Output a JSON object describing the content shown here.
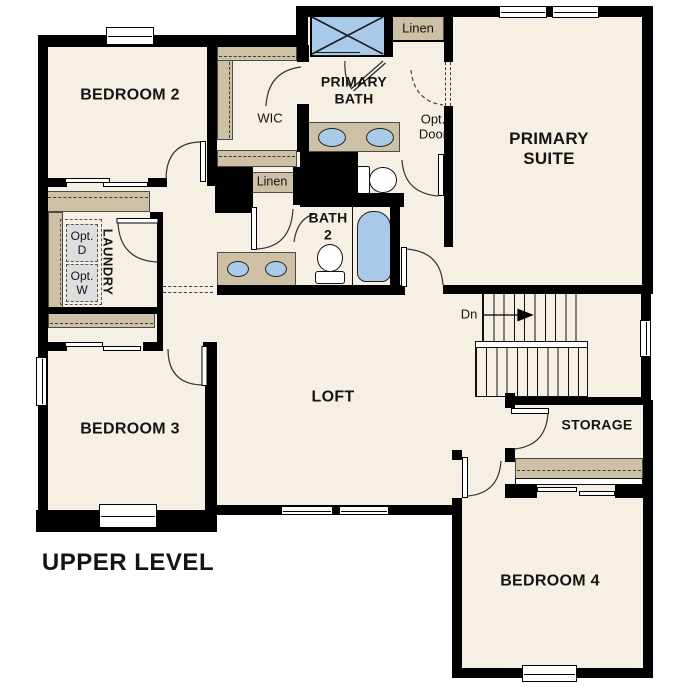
{
  "title": "UPPER LEVEL",
  "rooms": {
    "bedroom2": "BEDROOM 2",
    "wic": "WIC",
    "primary_bath": "PRIMARY BATH",
    "primary_suite": "PRIMARY SUITE",
    "bath2": "BATH 2",
    "laundry": "LAUNDRY",
    "bedroom3": "BEDROOM 3",
    "loft": "LOFT",
    "storage": "STORAGE",
    "bedroom4": "BEDROOM 4"
  },
  "closets": {
    "linen_primary": "Linen",
    "linen_hall": "Linen"
  },
  "annotations": {
    "opt_door": "Opt. Door",
    "opt_dryer": "Opt. D",
    "opt_washer": "Opt. W",
    "stairs_down": "Dn"
  },
  "colors": {
    "floor": "#f6efe3",
    "walls": "#000000",
    "casework_tan": "#cec0a5",
    "fixture_blue": "#a9c9e9",
    "optional_gray": "#dedede",
    "background": "#ffffff"
  }
}
